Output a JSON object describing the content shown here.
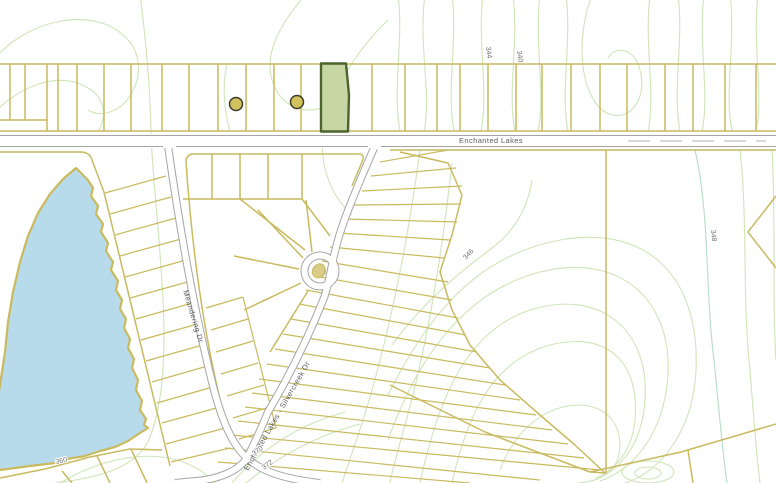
{
  "map": {
    "road_labels": {
      "enchanted_lakes": "Enchanted Lakes",
      "meandering": "Meandering Dr",
      "silvercreek": "Enchanted Lakes - Silvercreek Dr"
    },
    "contour_labels": {
      "c344": "344",
      "c340": "340",
      "c346": "346",
      "c348": "348",
      "c370": "370",
      "c372": "372",
      "c360": "360"
    },
    "colors": {
      "background": "#ffffff",
      "contour_line": "#cfe5b8",
      "contour_line_teal": "#b7dcc8",
      "parcel_line": "#c9ba5e",
      "road_casing": "#a5a5a5",
      "road_dash": "#b5b5b5",
      "road_label_text": "#5a5a5a",
      "contour_label_text": "#707070",
      "lake_fill": "#b8dbec",
      "lake_border": "#c9ba5e",
      "selected_parcel_fill": "#c6d7a5",
      "selected_parcel_border": "#4d642d",
      "marker_fill": "#d2c25e",
      "marker_border": "#3c3c2a",
      "culdesac_island_fill": "#d8cc86"
    }
  }
}
